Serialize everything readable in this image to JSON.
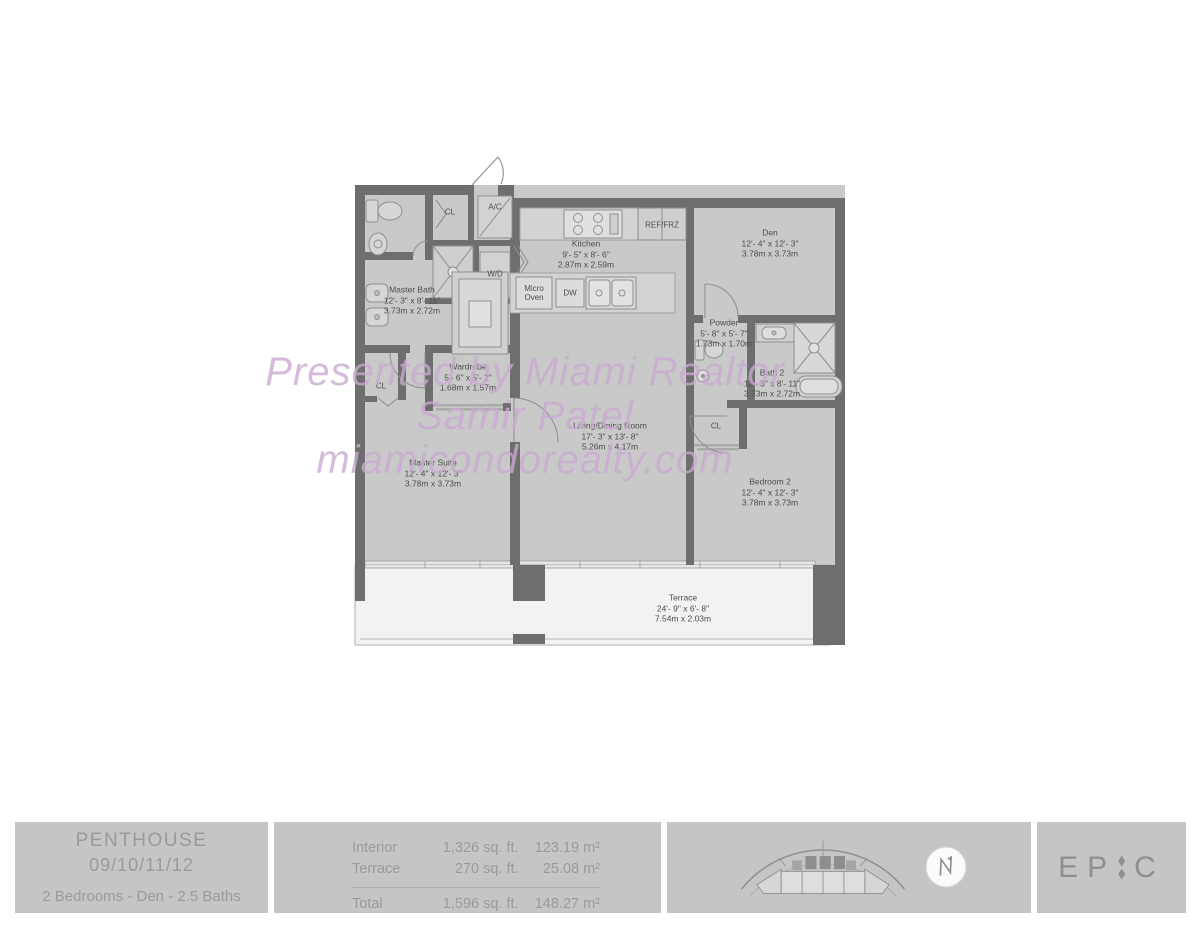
{
  "colors": {
    "wall": "#6e6e6e",
    "floor": "#c9c9c9",
    "terrace_floor": "#f2f2f2",
    "footer_bg": "#c5c5c5",
    "footer_text": "#9a9a9a",
    "watermark": "#c9a9d0",
    "label_text": "#4d4d4d"
  },
  "watermark": {
    "line1": "Presented by Miami Realtor",
    "line2": "Samir Patel",
    "line3": "miamicondorealty.com"
  },
  "plan": {
    "rooms": [
      {
        "name": "Kitchen",
        "imperial": "9'- 5\" x 8'- 6\"",
        "metric": "2.87m x 2.59m"
      },
      {
        "name": "Den",
        "imperial": "12'- 4\" x 12'- 3\"",
        "metric": "3.78m x 3.73m"
      },
      {
        "name": "Master Bath",
        "imperial": "12'- 3\" x 8'- 11\"",
        "metric": "3.73m x 2.72m"
      },
      {
        "name": "Wardrobe",
        "imperial": "5'- 6\" x 5'- 2\"",
        "metric": "1.68m x 1.57m"
      },
      {
        "name": "Powder",
        "imperial": "5'- 8\" x 5'- 7\"",
        "metric": "1.73m x 1.70m"
      },
      {
        "name": "Bath 2",
        "imperial": "12'- 3\" x 8'- 11\"",
        "metric": "3.73m x 2.72m"
      },
      {
        "name": "Living/Dining Room",
        "imperial": "17'- 3\" x 13'- 8\"",
        "metric": "5.26m x 4.17m"
      },
      {
        "name": "Master Suite",
        "imperial": "12'- 4\" x 12'- 3\"",
        "metric": "3.78m x 3.73m"
      },
      {
        "name": "Bedroom 2",
        "imperial": "12'- 4\" x 12'- 3\"",
        "metric": "3.78m x 3.73m"
      },
      {
        "name": "Terrace",
        "imperial": "24'- 9\" x 6'- 8\"",
        "metric": "7.54m x 2.03m"
      }
    ],
    "labels": {
      "cl_top": "CL",
      "ac": "A/C",
      "wd": "W/D",
      "ref": "REF/FRZ",
      "micro_line1": "Micro",
      "micro_line2": "Oven",
      "dw": "DW",
      "cl_master": "CL",
      "cl_bedroom2": "CL"
    }
  },
  "footer": {
    "unit": {
      "title": "PENTHOUSE",
      "stack": "09/10/11/12",
      "subtitle": "2 Bedrooms - Den - 2.5 Baths"
    },
    "areas": {
      "rows": [
        {
          "label": "Interior",
          "sqft": "1,326 sq. ft.",
          "sqm": "123.19 m²"
        },
        {
          "label": "Terrace",
          "sqft": "270 sq. ft.",
          "sqm": "25.08 m²"
        }
      ],
      "total": {
        "label": "Total",
        "sqft": "1,596 sq. ft.",
        "sqm": "148.27 m²"
      }
    },
    "brand": {
      "left": "EP",
      "right": "C"
    }
  },
  "icons": {
    "keyplan": "building-keyplan-icon",
    "compass": "north-arrow-icon"
  }
}
